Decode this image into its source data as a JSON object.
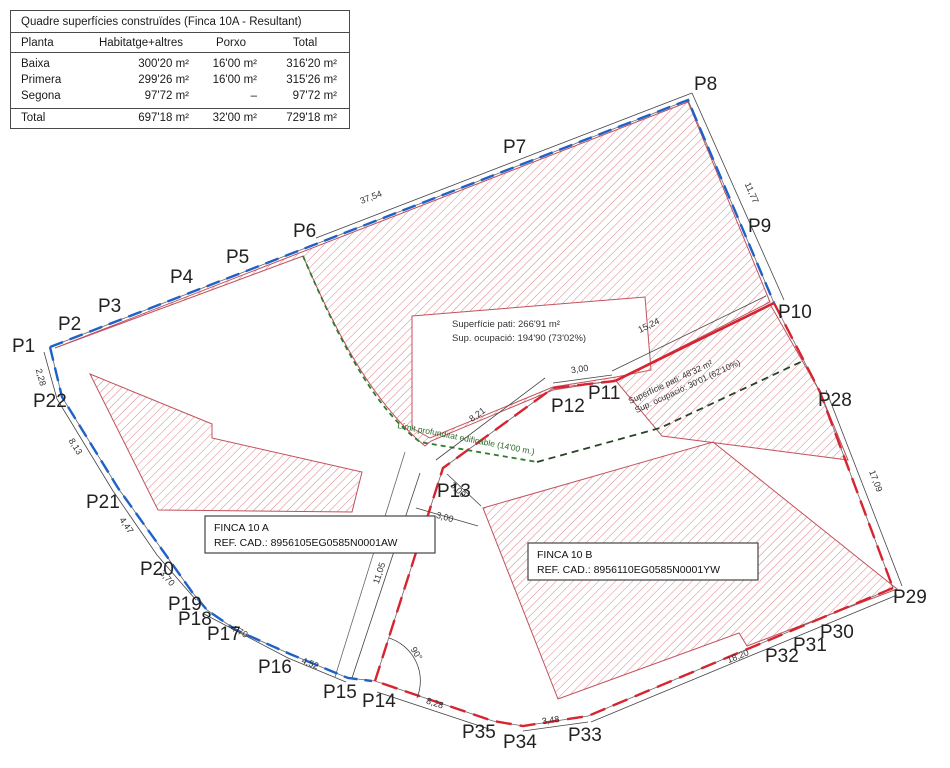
{
  "table": {
    "title": "Quadre superfícies construïdes (Finca 10A - Resultant)",
    "headers": [
      "Planta",
      "Habitatge+altres",
      "Porxo",
      "Total"
    ],
    "rows": [
      {
        "planta": "Baixa",
        "habitatge": "300'20 m²",
        "porxo": "16'00 m²",
        "total": "316'20 m²"
      },
      {
        "planta": "Primera",
        "habitatge": "299'26 m²",
        "porxo": "16'00 m²",
        "total": "315'26 m²"
      },
      {
        "planta": "Segona",
        "habitatge": "97'72 m²",
        "porxo": "–",
        "total": "97'72 m²"
      }
    ],
    "total_row": {
      "planta": "Total",
      "habitatge": "697'18 m²",
      "porxo": "32'00 m²",
      "total": "729'18 m²"
    }
  },
  "plan": {
    "points": {
      "p1": "P1",
      "p2": "P2",
      "p3": "P3",
      "p4": "P4",
      "p5": "P5",
      "p6": "P6",
      "p7": "P7",
      "p8": "P8",
      "p9": "P9",
      "p10": "P10",
      "p11": "P11",
      "p12": "P12",
      "p13": "P13",
      "p14": "P14",
      "p15": "P15",
      "p16": "P16",
      "p17": "P17",
      "p18": "P18",
      "p19": "P19",
      "p20": "P20",
      "p21": "P21",
      "p22": "P22",
      "p28": "P28",
      "p29": "P29",
      "p30": "P30",
      "p31": "P31",
      "p32": "P32",
      "p33": "P33",
      "p34": "P34",
      "p35": "P35"
    },
    "dims": {
      "top": "37,54",
      "right_upper": "11,77",
      "p11_p10": "15,24",
      "p28_p29": "17,09",
      "p1_p22": "2,28",
      "p22_p21": "8,13",
      "p21_p20": "4,47",
      "p20_p19": "3,70",
      "p18_p16": "4,70",
      "p16_p15": "4,52",
      "p14_p13": "11,05",
      "p13_p12": "8,21",
      "p12_p11": "3,00",
      "p13_diag": "3,00",
      "p13_base": "3,00",
      "p14_p35": "8,28",
      "p34_p33": "3,48",
      "p33_p29": "18,20"
    },
    "angle_label": "90°",
    "limit_label": "Límit profunditat edificable (14'00 m.)",
    "patio_a": {
      "line1": "Superfície pati: 266'91 m²",
      "line2": "Sup. ocupació: 194'90 (73'02%)"
    },
    "patio_b": {
      "line1": "Superfície pati: 48'32 m²",
      "line2": "Sup. ocupació: 30'01 (62'10%)"
    },
    "finca_a": {
      "name": "FINCA 10 A",
      "ref": "REF. CAD.: 8956105EG0585N0001AW"
    },
    "finca_b": {
      "name": "FINCA 10 B",
      "ref": "REF. CAD.: 8956110EG0585N0001YW"
    }
  },
  "colors": {
    "boundary_blue": "#1e62c8",
    "boundary_red": "#d62430",
    "limit_green": "#2e7d2e",
    "hatch_red": "#d9848c"
  }
}
